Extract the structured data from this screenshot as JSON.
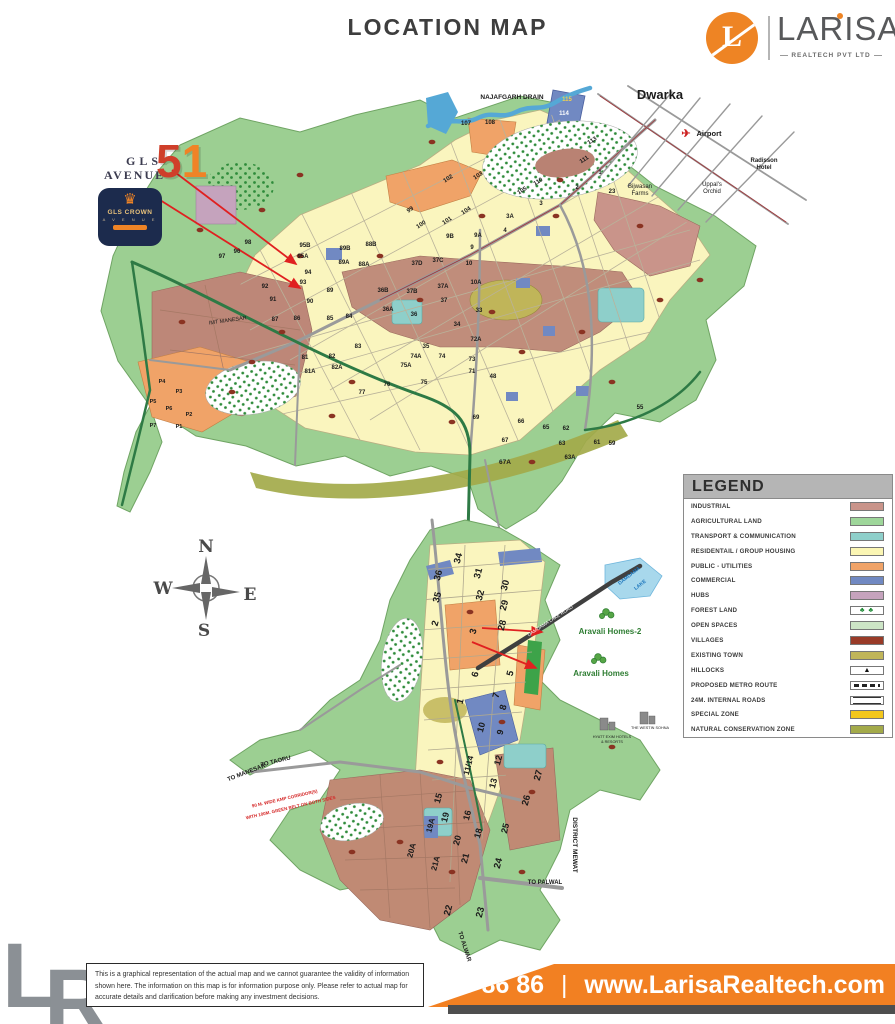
{
  "header": {
    "title": "LOCATION MAP"
  },
  "brand": {
    "monogram": "L",
    "name": "LARISA",
    "tagline": "REALTECH PVT LTD"
  },
  "gls": {
    "line1": "GLS",
    "line2": "AVENUE",
    "number_5": "5",
    "number_1": "1",
    "crown_icon": "♛",
    "crown_title": "GLS CROWN",
    "crown_sub": "A V E N U E"
  },
  "legend": {
    "title": "LEGEND",
    "items": [
      {
        "label": "INDUSTRIAL",
        "type": "color",
        "color": "#c9948a"
      },
      {
        "label": "AGRICULTURAL LAND",
        "type": "color",
        "color": "#9ed69a"
      },
      {
        "label": "TRANSPORT & COMMUNICATION",
        "type": "color",
        "color": "#8ecfca"
      },
      {
        "label": "RESIDENTAIL / GROUP HOUSING",
        "type": "color",
        "color": "#fbf6b4"
      },
      {
        "label": "PUBLIC - UTILITIES",
        "type": "color",
        "color": "#f0a368"
      },
      {
        "label": "COMMERCIAL",
        "type": "color",
        "color": "#7189c2"
      },
      {
        "label": "HUBS",
        "type": "color",
        "color": "#c5a3bd"
      },
      {
        "label": "FOREST LAND",
        "type": "forest",
        "color": "#ffffff"
      },
      {
        "label": "OPEN SPACES",
        "type": "color",
        "color": "#cde5c6"
      },
      {
        "label": "VILLAGES",
        "type": "color",
        "color": "#993b28"
      },
      {
        "label": "EXISTING TOWN",
        "type": "color",
        "color": "#c0b559"
      },
      {
        "label": "HILLOCKS",
        "type": "hillock",
        "color": "#ffffff"
      },
      {
        "label": "PROPOSED METRO ROUTE",
        "type": "metro",
        "color": "#ffffff"
      },
      {
        "label": "24M. INTERNAL ROADS",
        "type": "road",
        "color": "#ffffff"
      },
      {
        "label": "SPECIAL ZONE",
        "type": "color",
        "color": "#f3c71c"
      },
      {
        "label": "NATURAL CONSERVATION ZONE",
        "type": "color",
        "color": "#a3aa4a"
      }
    ]
  },
  "map": {
    "labels": [
      {
        "t": "Dwarka",
        "x": 660,
        "y": 99,
        "s": 13
      },
      {
        "t": "NAJAFGARH DRAIN",
        "x": 512,
        "y": 99,
        "s": 6.5
      },
      {
        "t": "✈",
        "x": 686,
        "y": 137,
        "s": 11,
        "c": "#cc1f1f"
      },
      {
        "t": "Airport",
        "x": 709,
        "y": 136,
        "s": 7.5
      },
      {
        "t": "Radisson",
        "x": 764,
        "y": 162,
        "s": 6
      },
      {
        "t": "Hotel",
        "x": 764,
        "y": 169,
        "s": 6
      },
      {
        "t": "Uppal's",
        "x": 712,
        "y": 186,
        "s": 6,
        "w": "normal"
      },
      {
        "t": "Orchid",
        "x": 712,
        "y": 193,
        "s": 6,
        "w": "normal"
      },
      {
        "t": "Bijwasan",
        "x": 640,
        "y": 188,
        "s": 6,
        "w": "normal"
      },
      {
        "t": "Farms",
        "x": 640,
        "y": 195,
        "s": 6,
        "w": "normal"
      },
      {
        "t": "115",
        "x": 567,
        "y": 101,
        "s": 6,
        "c": "#f5d04e"
      },
      {
        "t": "114",
        "x": 564,
        "y": 115,
        "s": 6,
        "c": "#ffffff"
      },
      {
        "t": "113",
        "x": 593,
        "y": 142,
        "s": 6,
        "r": -32
      },
      {
        "t": "111",
        "x": 585,
        "y": 161,
        "s": 6,
        "r": -32
      },
      {
        "t": "110",
        "x": 539,
        "y": 183,
        "s": 6,
        "r": -32
      },
      {
        "t": "105",
        "x": 523,
        "y": 192,
        "s": 6,
        "r": -32
      },
      {
        "t": "103",
        "x": 479,
        "y": 177,
        "s": 6,
        "r": -33
      },
      {
        "t": "102",
        "x": 449,
        "y": 180,
        "s": 6,
        "r": -33
      },
      {
        "t": "104",
        "x": 467,
        "y": 212,
        "s": 6,
        "r": -33
      },
      {
        "t": "101",
        "x": 448,
        "y": 222,
        "s": 6,
        "r": -33
      },
      {
        "t": "100",
        "x": 422,
        "y": 226,
        "s": 6,
        "r": -33
      },
      {
        "t": "99",
        "x": 411,
        "y": 211,
        "s": 6,
        "r": -33
      },
      {
        "t": "107",
        "x": 466,
        "y": 125,
        "s": 6
      },
      {
        "t": "108",
        "x": 490,
        "y": 124,
        "s": 6
      },
      {
        "t": "1",
        "x": 600,
        "y": 174,
        "s": 6
      },
      {
        "t": "2",
        "x": 577,
        "y": 189,
        "s": 6
      },
      {
        "t": "23",
        "x": 612,
        "y": 193,
        "s": 6
      },
      {
        "t": "3A",
        "x": 510,
        "y": 218,
        "s": 6
      },
      {
        "t": "3",
        "x": 541,
        "y": 205,
        "s": 6
      },
      {
        "t": "4",
        "x": 505,
        "y": 232,
        "s": 6
      },
      {
        "t": "9B",
        "x": 450,
        "y": 238,
        "s": 6
      },
      {
        "t": "9A",
        "x": 478,
        "y": 237,
        "s": 6
      },
      {
        "t": "9",
        "x": 472,
        "y": 249,
        "s": 6
      },
      {
        "t": "10",
        "x": 469,
        "y": 265,
        "s": 6
      },
      {
        "t": "10A",
        "x": 476,
        "y": 284,
        "s": 6
      },
      {
        "t": "37D",
        "x": 417,
        "y": 265,
        "s": 6
      },
      {
        "t": "37C",
        "x": 438,
        "y": 262,
        "s": 6
      },
      {
        "t": "37B",
        "x": 412,
        "y": 293,
        "s": 6
      },
      {
        "t": "37A",
        "x": 443,
        "y": 288,
        "s": 6
      },
      {
        "t": "37",
        "x": 444,
        "y": 302,
        "s": 6
      },
      {
        "t": "36B",
        "x": 383,
        "y": 292,
        "s": 6
      },
      {
        "t": "36A",
        "x": 388,
        "y": 311,
        "s": 6
      },
      {
        "t": "36",
        "x": 414,
        "y": 316,
        "s": 6
      },
      {
        "t": "34",
        "x": 457,
        "y": 326,
        "s": 6
      },
      {
        "t": "33",
        "x": 479,
        "y": 312,
        "s": 6
      },
      {
        "t": "35",
        "x": 426,
        "y": 348,
        "s": 6
      },
      {
        "t": "74A",
        "x": 416,
        "y": 358,
        "s": 6
      },
      {
        "t": "75A",
        "x": 406,
        "y": 367,
        "s": 6
      },
      {
        "t": "74",
        "x": 442,
        "y": 358,
        "s": 6
      },
      {
        "t": "73",
        "x": 472,
        "y": 361,
        "s": 6
      },
      {
        "t": "72A",
        "x": 476,
        "y": 341,
        "s": 6
      },
      {
        "t": "71",
        "x": 472,
        "y": 373,
        "s": 6
      },
      {
        "t": "48",
        "x": 493,
        "y": 378,
        "s": 6
      },
      {
        "t": "75",
        "x": 424,
        "y": 384,
        "s": 6
      },
      {
        "t": "76",
        "x": 387,
        "y": 386,
        "s": 6
      },
      {
        "t": "77",
        "x": 362,
        "y": 394,
        "s": 6
      },
      {
        "t": "83",
        "x": 358,
        "y": 348,
        "s": 6
      },
      {
        "t": "82",
        "x": 332,
        "y": 358,
        "s": 6
      },
      {
        "t": "82A",
        "x": 337,
        "y": 369,
        "s": 6
      },
      {
        "t": "81A",
        "x": 310,
        "y": 373,
        "s": 6
      },
      {
        "t": "81",
        "x": 305,
        "y": 359,
        "s": 6
      },
      {
        "t": "84",
        "x": 349,
        "y": 318,
        "s": 6
      },
      {
        "t": "85",
        "x": 330,
        "y": 320,
        "s": 6
      },
      {
        "t": "86",
        "x": 297,
        "y": 320,
        "s": 6
      },
      {
        "t": "87",
        "x": 275,
        "y": 321,
        "s": 6
      },
      {
        "t": "90",
        "x": 310,
        "y": 303,
        "s": 6
      },
      {
        "t": "89",
        "x": 330,
        "y": 292,
        "s": 6
      },
      {
        "t": "93",
        "x": 303,
        "y": 284,
        "s": 6
      },
      {
        "t": "94",
        "x": 308,
        "y": 274,
        "s": 6
      },
      {
        "t": "92",
        "x": 265,
        "y": 288,
        "s": 6
      },
      {
        "t": "91",
        "x": 273,
        "y": 301,
        "s": 6
      },
      {
        "t": "95B",
        "x": 305,
        "y": 247,
        "s": 6
      },
      {
        "t": "95A",
        "x": 303,
        "y": 258,
        "s": 6
      },
      {
        "t": "89B",
        "x": 345,
        "y": 250,
        "s": 6
      },
      {
        "t": "88B",
        "x": 371,
        "y": 246,
        "s": 6
      },
      {
        "t": "89A",
        "x": 344,
        "y": 264,
        "s": 6
      },
      {
        "t": "88A",
        "x": 364,
        "y": 266,
        "s": 6
      },
      {
        "t": "98",
        "x": 248,
        "y": 244,
        "s": 6
      },
      {
        "t": "96",
        "x": 237,
        "y": 253,
        "s": 6
      },
      {
        "t": "97",
        "x": 222,
        "y": 258,
        "s": 6
      },
      {
        "t": "IMT MANESAR",
        "x": 228,
        "y": 322,
        "s": 5.5,
        "r": -8,
        "w": "normal"
      },
      {
        "t": "P4",
        "x": 162,
        "y": 383,
        "s": 5.5
      },
      {
        "t": "P3",
        "x": 179,
        "y": 393,
        "s": 5.5
      },
      {
        "t": "P5",
        "x": 153,
        "y": 403,
        "s": 5.5
      },
      {
        "t": "P6",
        "x": 169,
        "y": 410,
        "s": 5.5
      },
      {
        "t": "P2",
        "x": 189,
        "y": 416,
        "s": 5.5
      },
      {
        "t": "P7",
        "x": 153,
        "y": 427,
        "s": 5.5
      },
      {
        "t": "P1",
        "x": 179,
        "y": 428,
        "s": 5.5
      },
      {
        "t": "69",
        "x": 476,
        "y": 419,
        "s": 6
      },
      {
        "t": "66",
        "x": 521,
        "y": 423,
        "s": 6
      },
      {
        "t": "65",
        "x": 546,
        "y": 429,
        "s": 6
      },
      {
        "t": "62",
        "x": 566,
        "y": 430,
        "s": 6
      },
      {
        "t": "63",
        "x": 562,
        "y": 445,
        "s": 6
      },
      {
        "t": "61",
        "x": 597,
        "y": 444,
        "s": 6
      },
      {
        "t": "59",
        "x": 612,
        "y": 445,
        "s": 6
      },
      {
        "t": "63A",
        "x": 570,
        "y": 459,
        "s": 6
      },
      {
        "t": "67",
        "x": 505,
        "y": 442,
        "s": 6
      },
      {
        "t": "67A",
        "x": 505,
        "y": 464,
        "s": 6.5
      },
      {
        "t": "55",
        "x": 640,
        "y": 409,
        "s": 6
      },
      {
        "t": "N",
        "x": 206,
        "y": 552,
        "s": 17,
        "f": "serif",
        "c": "#4a4a4a"
      },
      {
        "t": "W",
        "x": 163,
        "y": 594,
        "s": 17,
        "f": "serif",
        "c": "#4a4a4a"
      },
      {
        "t": "E",
        "x": 250,
        "y": 600,
        "s": 17,
        "f": "serif",
        "c": "#4a4a4a"
      },
      {
        "t": "S",
        "x": 204,
        "y": 636,
        "s": 17,
        "f": "serif",
        "c": "#4a4a4a"
      },
      {
        "t": "34",
        "x": 461,
        "y": 559,
        "s": 9.5,
        "r": -75
      },
      {
        "t": "36",
        "x": 441,
        "y": 576,
        "s": 9.5,
        "r": -75
      },
      {
        "t": "35",
        "x": 440,
        "y": 598,
        "s": 9.5,
        "r": -75
      },
      {
        "t": "31",
        "x": 481,
        "y": 574,
        "s": 9.5,
        "r": -75
      },
      {
        "t": "32",
        "x": 483,
        "y": 596,
        "s": 9.5,
        "r": -75
      },
      {
        "t": "30",
        "x": 508,
        "y": 586,
        "s": 9.5,
        "r": -75
      },
      {
        "t": "29",
        "x": 507,
        "y": 606,
        "s": 9.5,
        "r": -75
      },
      {
        "t": "28",
        "x": 505,
        "y": 626,
        "s": 9.5,
        "r": -75
      },
      {
        "t": "2",
        "x": 438,
        "y": 624,
        "s": 9.5,
        "r": -75
      },
      {
        "t": "3",
        "x": 476,
        "y": 632,
        "s": 9.5,
        "r": -75
      },
      {
        "t": "6",
        "x": 478,
        "y": 675,
        "s": 9.5,
        "r": -75
      },
      {
        "t": "5",
        "x": 513,
        "y": 674,
        "s": 9.5,
        "r": -75
      },
      {
        "t": "1",
        "x": 463,
        "y": 702,
        "s": 9.5,
        "r": -75
      },
      {
        "t": "7",
        "x": 499,
        "y": 696,
        "s": 9.5,
        "r": -75
      },
      {
        "t": "8",
        "x": 506,
        "y": 708,
        "s": 9.5,
        "r": -75
      },
      {
        "t": "10",
        "x": 484,
        "y": 728,
        "s": 9,
        "r": -75
      },
      {
        "t": "9",
        "x": 503,
        "y": 733,
        "s": 9,
        "r": -75
      },
      {
        "t": "12",
        "x": 501,
        "y": 761,
        "s": 9,
        "r": -75
      },
      {
        "t": "13",
        "x": 496,
        "y": 784,
        "s": 9,
        "r": -75
      },
      {
        "t": "11/14",
        "x": 471,
        "y": 766,
        "s": 8,
        "r": -75
      },
      {
        "t": "27",
        "x": 541,
        "y": 776,
        "s": 9.5,
        "r": -75
      },
      {
        "t": "26",
        "x": 529,
        "y": 801,
        "s": 9.5,
        "r": -75
      },
      {
        "t": "15",
        "x": 441,
        "y": 799,
        "s": 9,
        "r": -75
      },
      {
        "t": "16",
        "x": 470,
        "y": 816,
        "s": 9,
        "r": -75
      },
      {
        "t": "19",
        "x": 448,
        "y": 818,
        "s": 9,
        "r": -75
      },
      {
        "t": "19A",
        "x": 433,
        "y": 826,
        "s": 8,
        "r": -75
      },
      {
        "t": "20",
        "x": 460,
        "y": 841,
        "s": 9,
        "r": -75
      },
      {
        "t": "20A",
        "x": 414,
        "y": 851,
        "s": 8,
        "r": -75
      },
      {
        "t": "21",
        "x": 468,
        "y": 859,
        "s": 9,
        "r": -75
      },
      {
        "t": "21A",
        "x": 438,
        "y": 864,
        "s": 8,
        "r": -75
      },
      {
        "t": "25",
        "x": 508,
        "y": 829,
        "s": 9,
        "r": -75
      },
      {
        "t": "24",
        "x": 501,
        "y": 864,
        "s": 9.5,
        "r": -75
      },
      {
        "t": "18",
        "x": 481,
        "y": 834,
        "s": 9,
        "r": -75
      },
      {
        "t": "22",
        "x": 451,
        "y": 911,
        "s": 9.5,
        "r": -75
      },
      {
        "t": "23",
        "x": 483,
        "y": 913,
        "s": 9.5,
        "r": -75
      },
      {
        "t": "DAMDAMA",
        "x": 630,
        "y": 577,
        "s": 5,
        "r": -38,
        "c": "#1b75bc"
      },
      {
        "t": "LAKE",
        "x": 641,
        "y": 586,
        "s": 5,
        "r": -38,
        "c": "#1b75bc"
      },
      {
        "t": "DAMDAMA LAKE ROAD",
        "x": 551,
        "y": 622,
        "s": 4.8,
        "r": -33,
        "c": "#ffffff",
        "w": "normal"
      },
      {
        "t": "Aravali Homes-2",
        "x": 610,
        "y": 634,
        "s": 8,
        "c": "#2e7d32"
      },
      {
        "t": "Aravali Homes",
        "x": 601,
        "y": 676,
        "s": 8,
        "c": "#2e7d32"
      },
      {
        "t": "HYATT EXIM HOTELS",
        "x": 612,
        "y": 738,
        "s": 3.8,
        "w": "normal"
      },
      {
        "t": "& RESORTS",
        "x": 612,
        "y": 743,
        "s": 3.8,
        "w": "normal"
      },
      {
        "t": "THE WESTIN SOHNA",
        "x": 650,
        "y": 729,
        "s": 3.8,
        "w": "normal"
      },
      {
        "t": "TO TAORU",
        "x": 276,
        "y": 763,
        "s": 6,
        "r": -14
      },
      {
        "t": "TO MANESAR",
        "x": 247,
        "y": 774,
        "s": 6,
        "r": -21
      },
      {
        "t": "90 M. WIDE KMP CORRIDOR(S)",
        "x": 285,
        "y": 800,
        "s": 4.5,
        "r": -13,
        "c": "#d42424"
      },
      {
        "t": "WITH 100M. GREEN BELT ON BOTH SIDES",
        "x": 291,
        "y": 809,
        "s": 4.5,
        "r": -13,
        "c": "#d42424"
      },
      {
        "t": "TO PALWAL",
        "x": 545,
        "y": 884,
        "s": 6
      },
      {
        "t": "DISTRICT MEWAT",
        "x": 573,
        "y": 845,
        "s": 6.5,
        "r": 90
      },
      {
        "t": "TO ALWAR",
        "x": 463,
        "y": 947,
        "s": 6,
        "r": 72
      }
    ],
    "villages": [
      [
        200,
        230
      ],
      [
        300,
        175
      ],
      [
        432,
        142
      ],
      [
        482,
        216
      ],
      [
        556,
        216
      ],
      [
        640,
        226
      ],
      [
        282,
        332
      ],
      [
        352,
        382
      ],
      [
        522,
        352
      ],
      [
        582,
        332
      ],
      [
        452,
        422
      ],
      [
        612,
        382
      ],
      [
        182,
        322
      ],
      [
        232,
        392
      ],
      [
        332,
        416
      ],
      [
        560,
        180
      ],
      [
        660,
        300
      ],
      [
        700,
        280
      ],
      [
        420,
        300
      ],
      [
        492,
        312
      ],
      [
        380,
        256
      ],
      [
        300,
        256
      ],
      [
        252,
        362
      ],
      [
        532,
        462
      ],
      [
        470,
        612
      ],
      [
        502,
        722
      ],
      [
        440,
        762
      ],
      [
        532,
        792
      ],
      [
        452,
        872
      ],
      [
        400,
        842
      ],
      [
        522,
        872
      ],
      [
        352,
        852
      ],
      [
        612,
        747
      ],
      [
        262,
        210
      ]
    ]
  },
  "footer": {
    "watermark_l": "L",
    "watermark_r": "R",
    "disclaimer_1": "This is a graphical representation of the actual map and we cannot guarantee the validity of information shown here.",
    "disclaimer_2": "The information on this map is for information purpose only. Please refer to actual map for accurate details and",
    "disclaimer_3": "clarification before making any investment decisions.",
    "phone": "8750 86 86 86",
    "separator": "|",
    "website": "www.LarisaRealtech.com"
  },
  "colors": {
    "accent_orange": "#f28022",
    "logo_orange": "#ee8424",
    "agri_green": "#9ccf92",
    "residential_yellow": "#faf5be",
    "industrial_brown": "#c08d7b",
    "village_red": "#8a3322",
    "commercial_blue": "#7189c2",
    "road_green": "#2e7a45",
    "drain_blue": "#55a8d6"
  }
}
